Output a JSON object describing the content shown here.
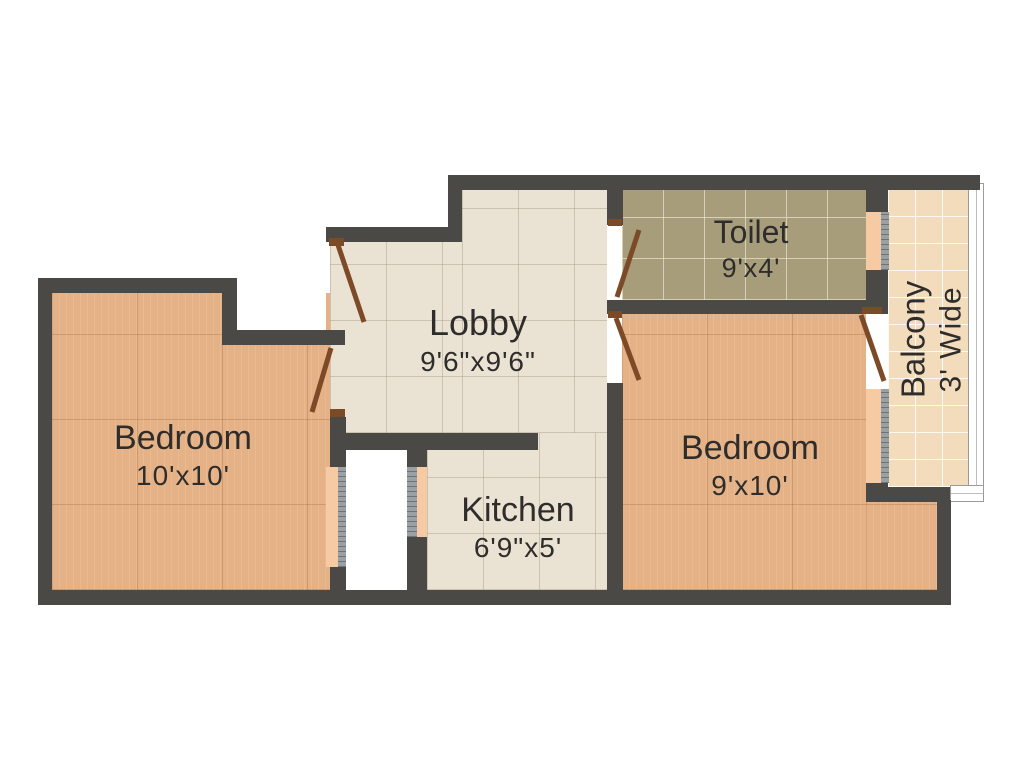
{
  "rooms": [
    {
      "id": "bedroom-left",
      "name": "Bedroom",
      "dimensions": "10'x10'"
    },
    {
      "id": "lobby",
      "name": "Lobby",
      "dimensions": "9'6\"x9'6\""
    },
    {
      "id": "kitchen",
      "name": "Kitchen",
      "dimensions": "6'9\"x5'"
    },
    {
      "id": "toilet",
      "name": "Toilet",
      "dimensions": "9'x4'"
    },
    {
      "id": "bedroom-right",
      "name": "Bedroom",
      "dimensions": "9'x10'"
    },
    {
      "id": "balcony",
      "name": "Balcony",
      "dimensions": "3' Wide"
    }
  ],
  "colors": {
    "wall": "#4b4946",
    "wood_floor": "#e4b286",
    "tile_floor": "#eae3d4",
    "toilet_floor": "#a79d7b",
    "balcony_floor": "#f2dcbb",
    "door": "#7c4a26",
    "window_sill": "#f6caa2",
    "window_glass": "#9aa0a4",
    "text": "#2f2d2b",
    "background": "#ffffff",
    "railing_border": "#9b9b9b"
  }
}
